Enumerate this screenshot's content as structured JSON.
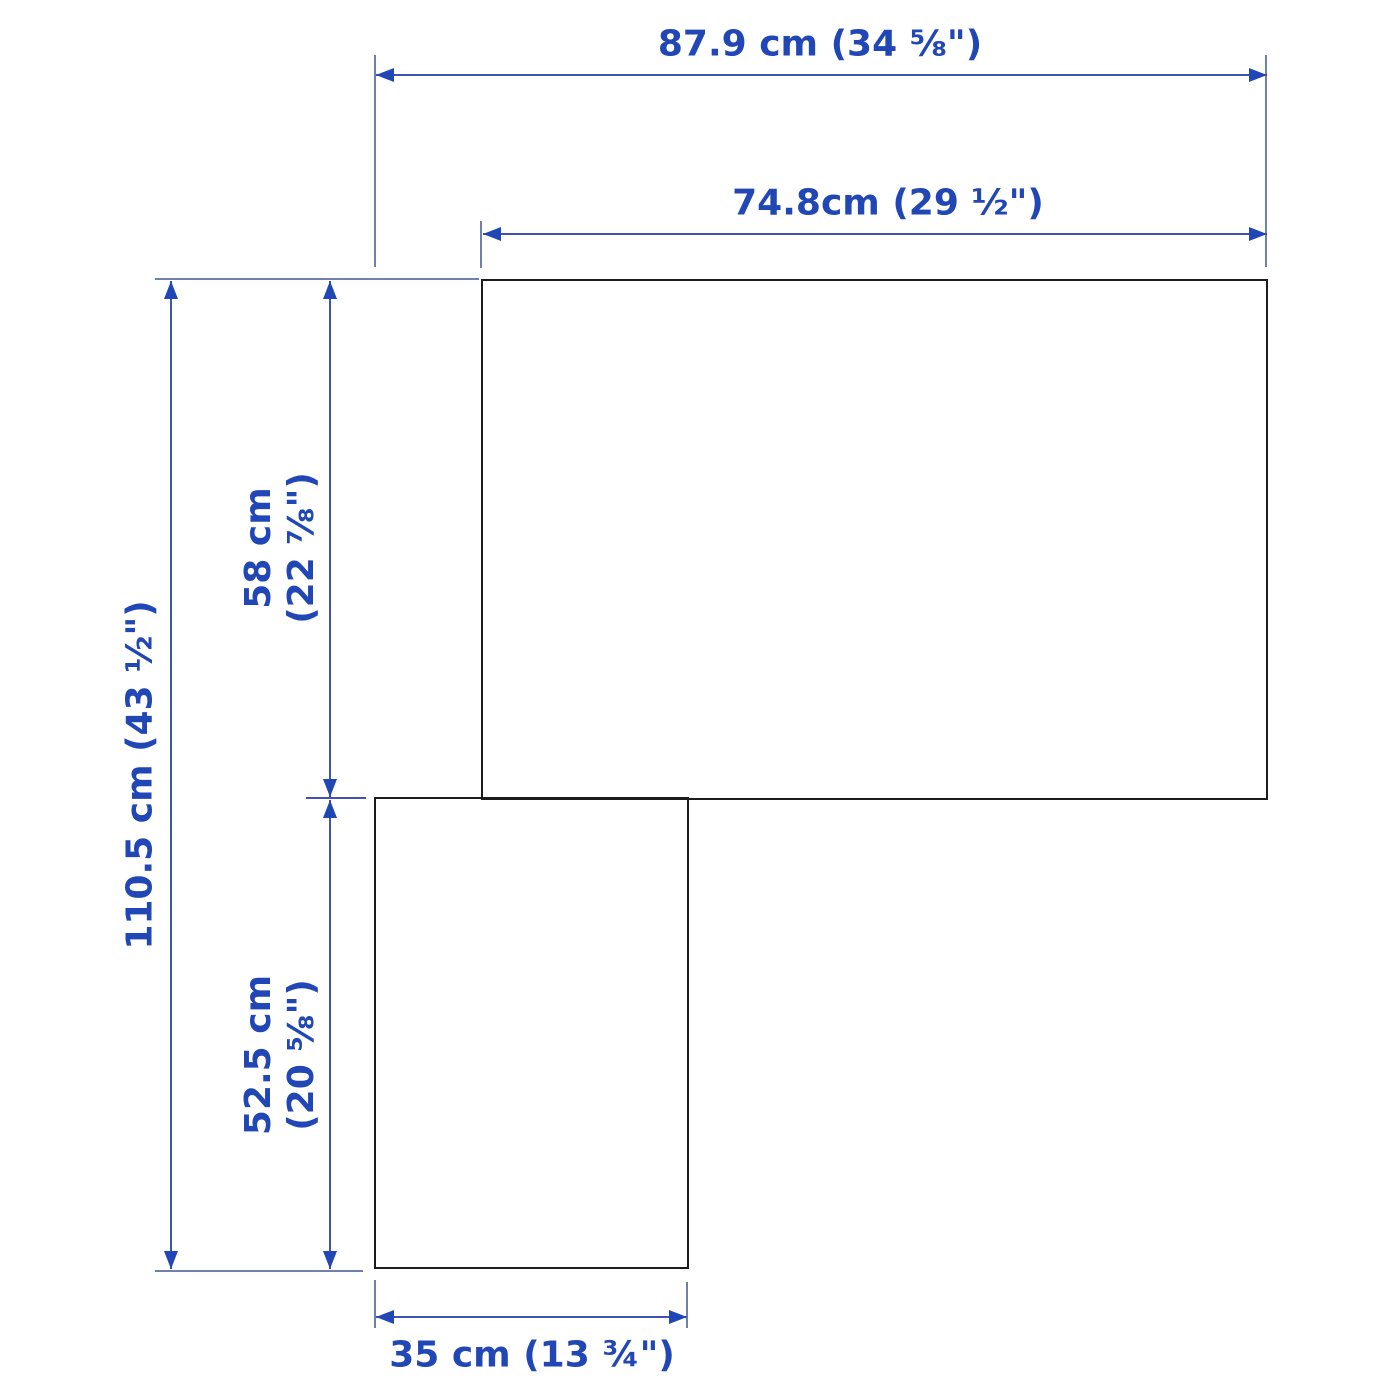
{
  "diagram": {
    "description": "Top-view dimension drawing of an L-shaped corner furniture unit with two rectangular panels",
    "dimensions": {
      "overall_width": "87.9 cm (34 ⅝\")",
      "upper_panel_width": "74.8cm (29 ½\")",
      "overall_depth": "110.5 cm (43 ½\")",
      "upper_panel_depth_cm": "58 cm",
      "upper_panel_depth_in": "(22 ⅞\")",
      "lower_panel_depth_cm": "52.5 cm",
      "lower_panel_depth_in": "(20 ⅝\")",
      "lower_panel_width": "35 cm (13 ¾\")"
    },
    "colors": {
      "label_text": "#2146b5",
      "dimension_line": "#4053b4",
      "extension_line": "#7080ad",
      "shape_outline": "#1c1c1c",
      "background": "#ffffff"
    }
  }
}
